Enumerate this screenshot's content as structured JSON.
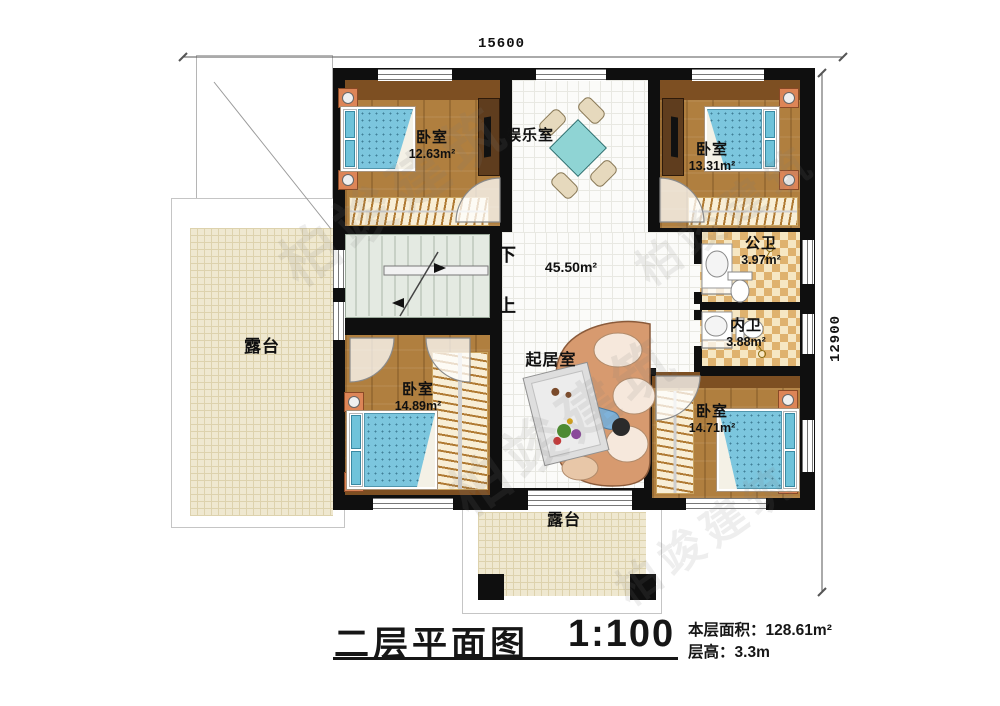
{
  "plan": {
    "dimensions": {
      "top": "15600",
      "right": "12900"
    },
    "stairs": {
      "down": "下",
      "up": "上"
    },
    "rooms": {
      "bedroom_top_left": {
        "name": "卧室",
        "area": "12.63m²"
      },
      "entertainment": {
        "name": "娱乐室"
      },
      "bedroom_top_right": {
        "name": "卧室",
        "area": "13.31m²"
      },
      "public_bathroom": {
        "name": "公卫",
        "area": "3.97m²"
      },
      "inner_bathroom": {
        "name": "内卫",
        "area": "3.88m²"
      },
      "terrace_left": {
        "name": "露台"
      },
      "living_room": {
        "name": "起居室",
        "area": "45.50m²"
      },
      "bedroom_bottom_left": {
        "name": "卧室",
        "area": "14.89m²"
      },
      "bedroom_bottom_right": {
        "name": "卧室",
        "area": "14.71m²"
      },
      "terrace_bottom": {
        "name": "露台"
      }
    }
  },
  "title_block": {
    "title": "二层平面图",
    "scale": "1:100",
    "area_label": "本层面积：",
    "area_value": "128.61m²",
    "floor_height_label": "层高：",
    "floor_height_value": "3.3m"
  },
  "watermark": {
    "text": "柏竣建筑"
  }
}
